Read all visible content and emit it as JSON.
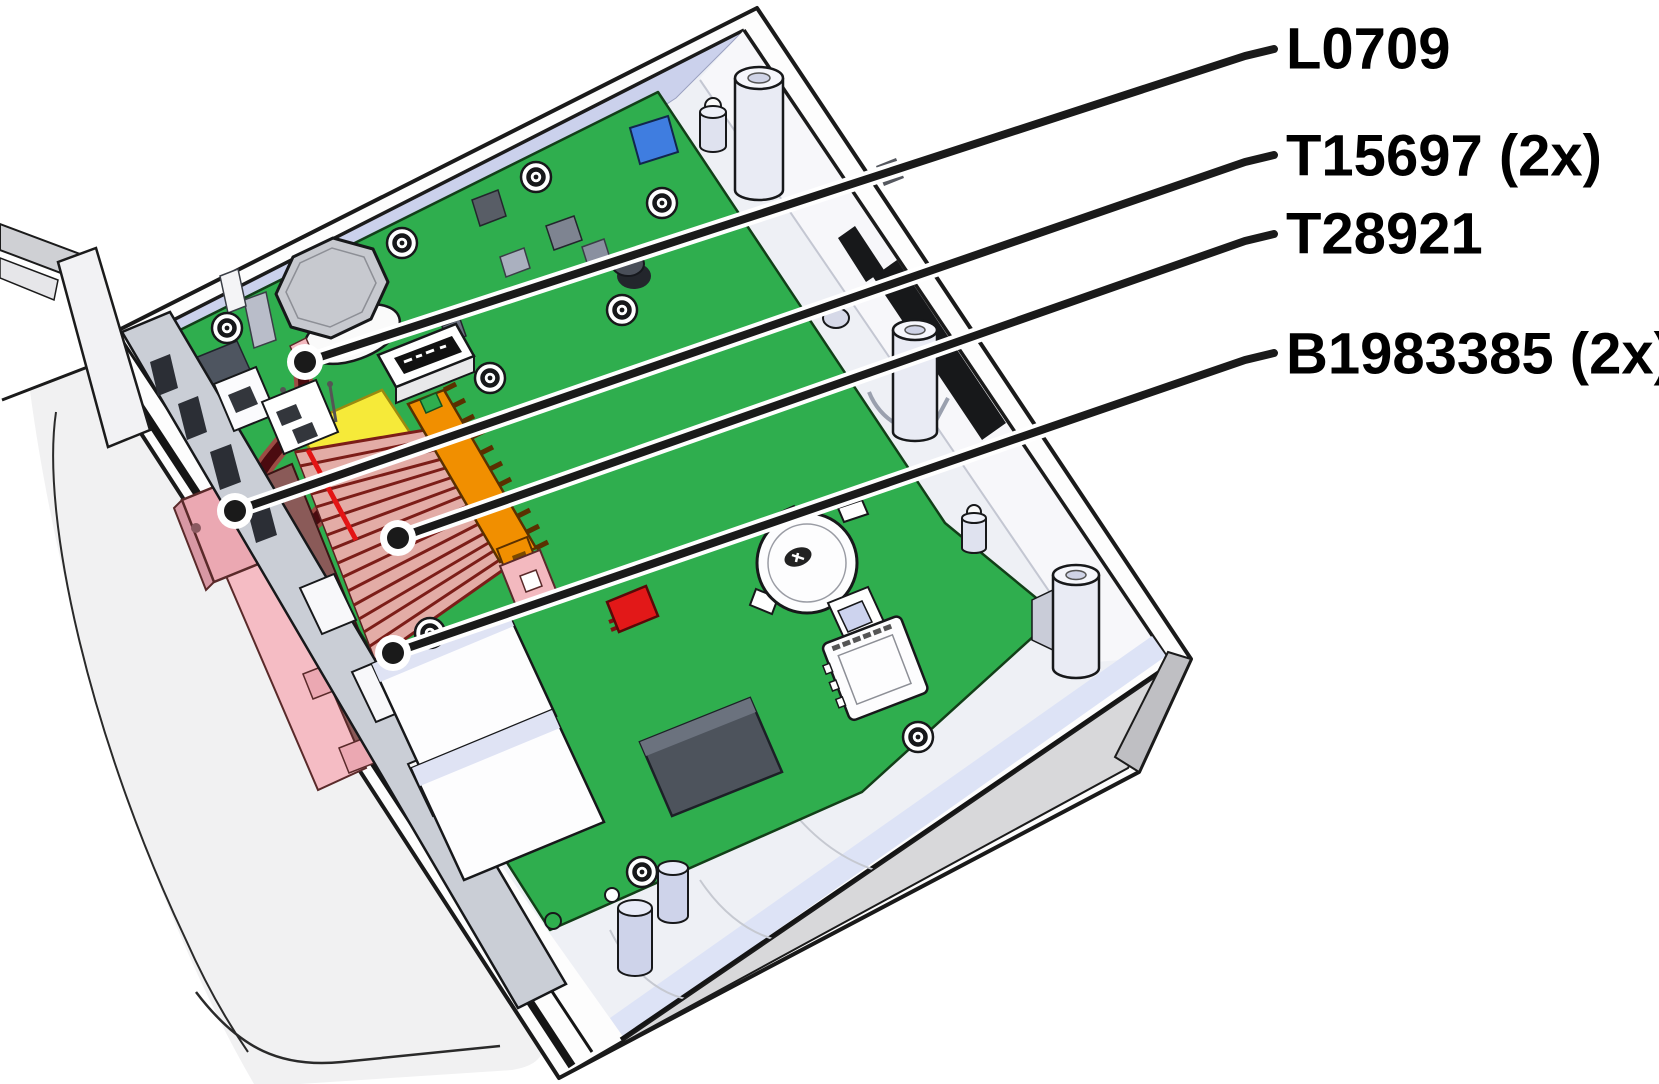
{
  "diagram": {
    "type": "technical-parts-callout",
    "subject": "opened device enclosure with green circuit board",
    "labels": [
      {
        "text": "L0709",
        "quantity": 1,
        "points_to": "wire-coil-inductor"
      },
      {
        "text": "T15697 (2x)",
        "quantity": 2,
        "points_to": "ribbon-cable-end-connector"
      },
      {
        "text": "T28921",
        "quantity": 1,
        "points_to": "flat-ribbon-cable"
      },
      {
        "text": "B1983385 (2x)",
        "quantity": 2,
        "points_to": "cable-retainer-clip"
      }
    ],
    "colors": {
      "background": "#ffffff",
      "pcb_green": "#2fae4e",
      "case_gray": "#d8d8da",
      "lid_gray": "#f1f1f2",
      "ribbon_pink": "#e3aca6",
      "ribbon_stripe": "#7c1d18",
      "connector_pink": "#eba8b2",
      "connector_orange": "#f18f00",
      "component_yellow": "#f6ea39",
      "component_red": "#e21818",
      "component_blue": "#3f7de0",
      "wire_maroon": "#4b0b10",
      "leader_line": "#1a1a1a",
      "label_text": "#000000"
    }
  }
}
